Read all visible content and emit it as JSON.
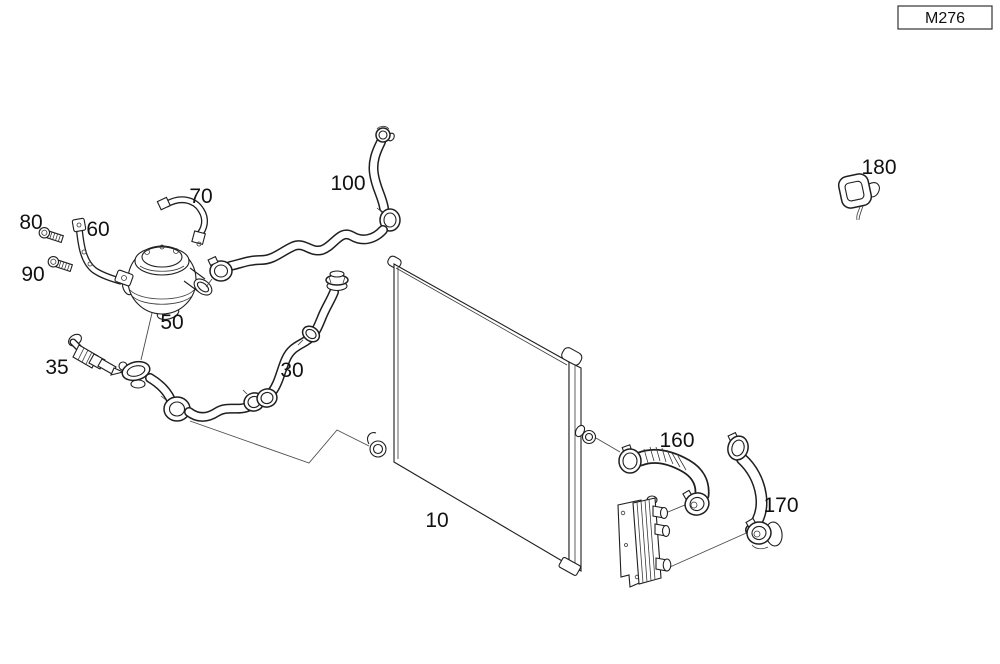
{
  "engine_code": "M276",
  "callouts": {
    "radiator": "10",
    "hose_assembly": "30",
    "sensor": "35",
    "aux_water_pump": "50",
    "bracket": "60",
    "hose_small": "70",
    "screw_upper": "80",
    "screw_lower": "90",
    "hose_upper": "100",
    "hose_corrugated": "160",
    "hose_oil_cooler": "170",
    "clip": "180"
  },
  "colors": {
    "background": "#ffffff",
    "line": "#1f1f1f"
  }
}
